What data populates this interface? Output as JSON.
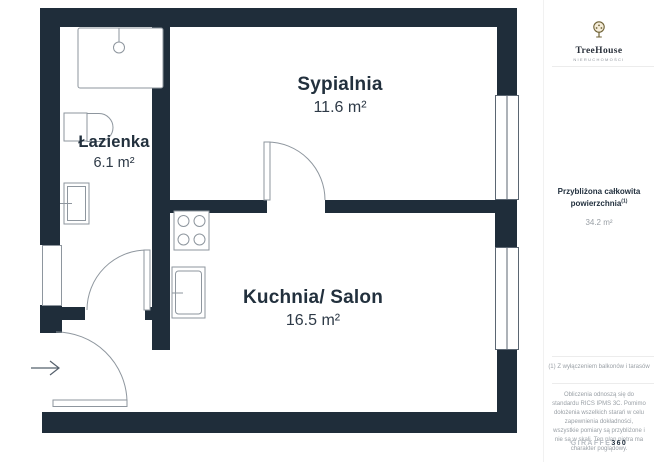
{
  "plan": {
    "rooms": [
      {
        "name": "Sypialnia",
        "area": "11.6 m²"
      },
      {
        "name": "Łazienka",
        "area": "6.1 m²"
      },
      {
        "name": "Kuchnia/ Salon",
        "area": "16.5 m²"
      }
    ],
    "icons": {
      "entrance_arrow": "arrow-right",
      "fixtures": [
        "shower",
        "toilet",
        "washbasin",
        "stove",
        "kitchen-sink"
      ]
    }
  },
  "sidebar": {
    "logo": {
      "icon": "tree-icon",
      "brand": "TreeHouse",
      "tagline": "NIERUCHOMOŚCI"
    },
    "summary": {
      "title": "Przybliżona całkowita powierzchnia",
      "superscript": "(1)",
      "value": "34.2 m²"
    },
    "footnote": "(1) Z wyłączeniem balkonów i tarasów",
    "disclaimer": "Obliczenia odnoszą się do standardu RICS IPMS 3C. Pomimo dołożenia wszelkich starań w celu zapewnienia dokładności, wszystkie pomiary są przybliżone i nie są w skali. Ten plan piętra ma charakter poglądowy.",
    "watermark": {
      "brand": "GIRAFFE",
      "suffix": "360"
    }
  },
  "colors": {
    "wall": "#1f2d3a",
    "fixture_line": "#8e969e",
    "logo_gold": "#6f6236",
    "muted_text": "#9aa0a6"
  }
}
